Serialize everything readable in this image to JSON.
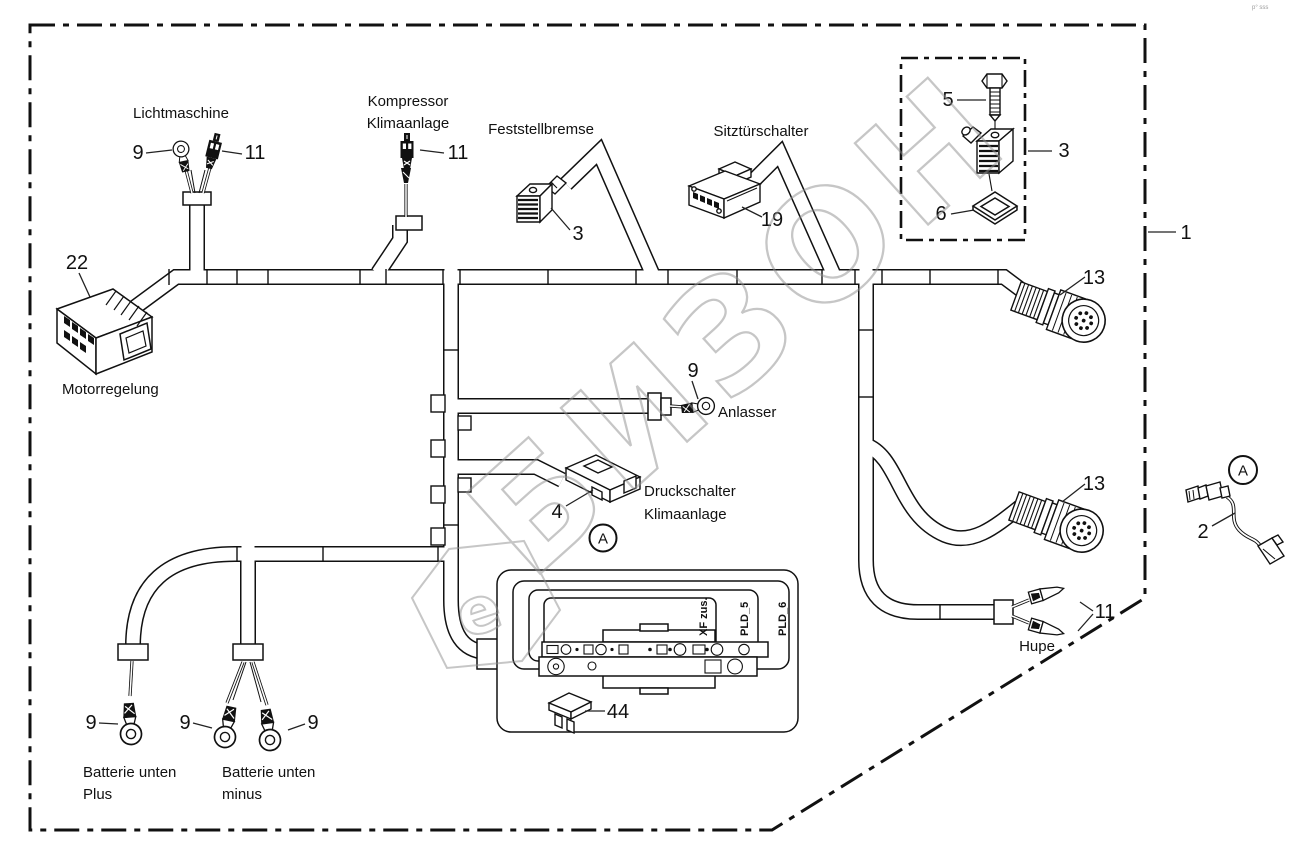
{
  "watermark": {
    "text": "БИЗОН",
    "symbol": "e",
    "color": "#8f8f8f"
  },
  "corner_note": "p° sss",
  "callouts": {
    "frame": "1",
    "licht_ring": "9",
    "licht_plug": "11",
    "komp_plug": "11",
    "fest": "3",
    "sitz": "19",
    "kit_bolt": "5",
    "kit_conn": "3",
    "kit_seal": "6",
    "motor": "22",
    "anlasser_ring": "9",
    "druck": "4",
    "fuse": "44",
    "batt_plus": "9",
    "batt_minus_left": "9",
    "batt_minus_right": "9",
    "conn13_top": "13",
    "conn13_bottom": "13",
    "hupe": "11",
    "pigtail": "2"
  },
  "labels": {
    "lichtmaschine": "Lichtmaschine",
    "kompressor_1": "Kompressor",
    "kompressor_2": "Klimaanlage",
    "feststellbremse": "Feststellbremse",
    "sitztuerschalter": "Sitztürschalter",
    "motorregelung": "Motorregelung",
    "anlasser": "Anlasser",
    "druckschalter_1": "Druckschalter",
    "druckschalter_2": "Klimaanlage",
    "hupe": "Hupe",
    "batt_plus_1": "Batterie unten",
    "batt_plus_2": "Plus",
    "batt_minus_1": "Batterie unten",
    "batt_minus_2": "minus",
    "ecu_xf": "XF zus.",
    "ecu_pld5": "PLD_5",
    "ecu_pld6": "PLD_6",
    "marker_a": "A"
  }
}
